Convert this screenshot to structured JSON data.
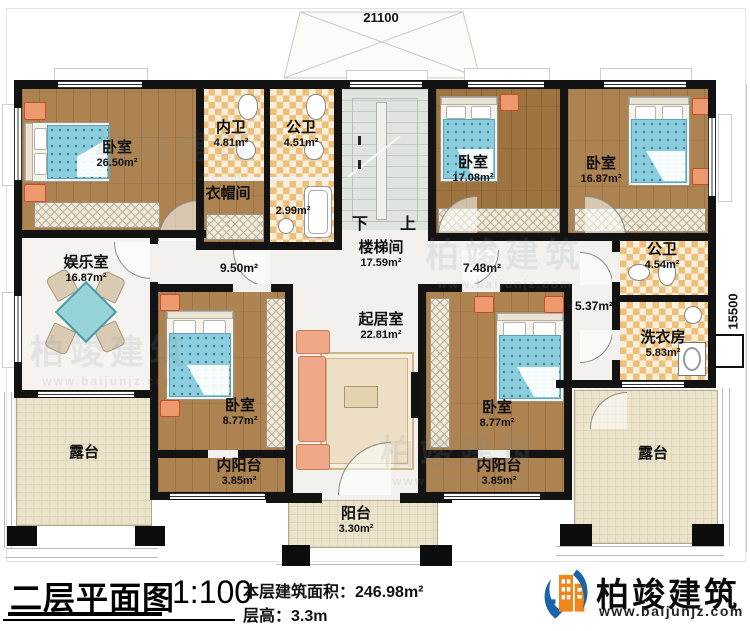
{
  "plan": {
    "dim_top": "21100",
    "dim_right": "15500",
    "stairs": {
      "down_label": "下",
      "up_label": "上"
    },
    "rooms": {
      "bedroom_tl": {
        "name": "卧室",
        "area": "26.50m²"
      },
      "inner_bath": {
        "name": "内卫",
        "area": "4.81m²"
      },
      "public_bath_top": {
        "name": "公卫",
        "area": "4.51m²"
      },
      "shower": {
        "area": "2.99m²"
      },
      "cloakroom": {
        "name": "衣帽间"
      },
      "stairwell": {
        "name": "楼梯间",
        "area": "17.59m²"
      },
      "bedroom_tm": {
        "name": "卧室",
        "area": "17.08m²"
      },
      "bedroom_tr": {
        "name": "卧室",
        "area": "16.87m²"
      },
      "entertainment": {
        "name": "娱乐室",
        "area": "16.87m²"
      },
      "hall_left": {
        "area": "9.50m²"
      },
      "hall_right": {
        "area": "7.48m²"
      },
      "hall_se": {
        "area": "5.37m²"
      },
      "living": {
        "name": "起居室",
        "area": "22.81m²"
      },
      "bedroom_ml": {
        "name": "卧室",
        "area": "8.77m²"
      },
      "bedroom_mr": {
        "name": "卧室",
        "area": "8.77m²"
      },
      "public_bath_right": {
        "name": "公卫",
        "area": "4.54m²"
      },
      "laundry": {
        "name": "洗衣房",
        "area": "5.83m²"
      },
      "terrace_left": {
        "name": "露台"
      },
      "inner_balcony_left": {
        "name": "内阳台",
        "area": "3.85m²"
      },
      "inner_balcony_right": {
        "name": "内阳台",
        "area": "3.85m²"
      },
      "terrace_right": {
        "name": "露台"
      },
      "balcony": {
        "name": "阳台",
        "area": "3.30m²"
      }
    }
  },
  "titleblock": {
    "title": "二层平面图",
    "scale": "1:100",
    "area_line": "本层建筑面积：246.98m²",
    "height_line": "层高：3.3m",
    "brand": "柏竣建筑",
    "website": "www.baijunjz.com"
  },
  "watermark": {
    "brand": "柏竣建筑",
    "website": "www.baijunjz.com"
  },
  "colors": {
    "wall": "#131313",
    "wood_floor": "#ad8352",
    "tile_floor": "#ecbf7d",
    "stair_floor": "#dfe5de",
    "terrace_floor": "#ebe3ca",
    "bed_blue": "#8ccddd",
    "nightstand": "#ec9a6d",
    "brand_blue": "#1b63a8",
    "brand_orange": "#f08519"
  }
}
